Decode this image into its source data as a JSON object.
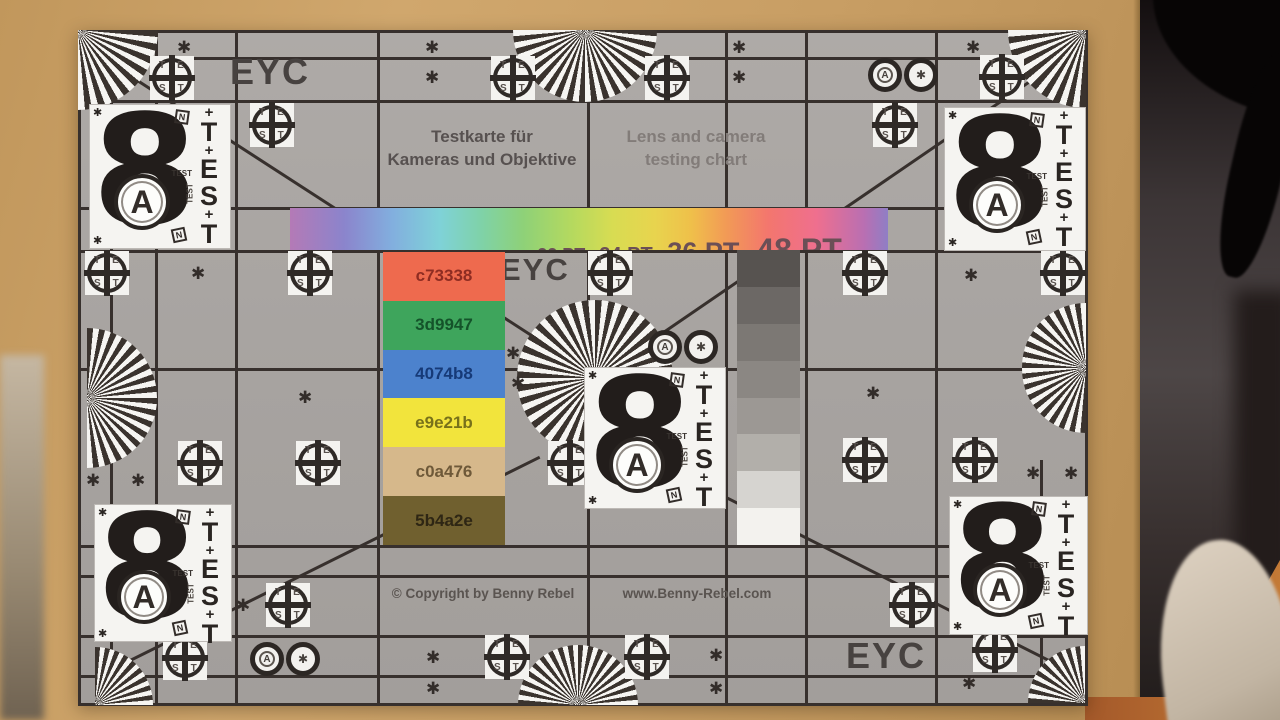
{
  "scene": {
    "cardboard_css": "background:linear-gradient(105deg,#c1975c,#d0a76d 30%,#c89e64 62%,#b88e54)",
    "wall_css": "background:linear-gradient(180deg,#140f10,#3c3536 28%,#4d4646 52%,#372f2e 76%,#201b1a)",
    "bag_css": "background:linear-gradient(160deg,#ded2c2,#c2b5a3 70%,#a89a86)",
    "wood_css": "background:linear-gradient(90deg,#a4592a,#c47a36)",
    "couch_css": "background:linear-gradient(180deg,#c5b7a2,#978871 60%,#6f6251)"
  },
  "chart": {
    "eyc": "EYC",
    "title_de": "Testkarte für\nKameras und Objektive",
    "title_en": "Lens and camera\ntesting chart",
    "copyright": "© Copyright by Benny Rebel",
    "website": "www.Benny-Rebel.com",
    "asterisk": "✱",
    "crosshair": {
      "top": "TE",
      "bottom": "ST"
    },
    "target8": {
      "digit": "8",
      "a": "A",
      "plus": "+",
      "n": "N",
      "small_test": "TEST",
      "test": [
        "T",
        "E",
        "S",
        "T"
      ]
    },
    "font_bar": {
      "gradient_css": "background:linear-gradient(90deg,#b47ab6 0%,#8b84cc 9%,#82aede 17%,#7fd2d8 25%,#7fd2a8 32%,#8ed178 39%,#b4d95f 47%,#d8dc52 54%,#e8d44e 61%,#efc04a 67%,#f29a56 73%,#f3766e 80%,#ef6f8e 88%,#b96fb2 96%,#8f7ec5 100%)",
      "labels": [
        {
          "text": "8 PT",
          "style": "font-size:7px"
        },
        {
          "text": "-",
          "style": "font-size:8px"
        },
        {
          "text": "10 PT",
          "style": "font-size:8px"
        },
        {
          "text": "-",
          "style": "font-size:9px"
        },
        {
          "text": "12 PT",
          "style": "font-size:10px"
        },
        {
          "text": "-",
          "style": "font-size:10px"
        },
        {
          "text": "14 PT",
          "style": "font-size:11px"
        },
        {
          "text": "-",
          "style": "font-size:12px"
        },
        {
          "text": "16 PT",
          "style": "font-size:13px"
        },
        {
          "text": "-",
          "style": "font-size:13px"
        },
        {
          "text": "18 PT",
          "style": "font-size:15px"
        },
        {
          "text": "-",
          "style": "font-size:15px"
        },
        {
          "text": "22 PT",
          "style": "font-size:18px"
        },
        {
          "text": "-",
          "style": "font-size:18px"
        },
        {
          "text": "24 PT",
          "style": "font-size:20px"
        },
        {
          "text": "-",
          "style": "font-size:20px"
        },
        {
          "text": "36 PT",
          "style": "font-size:27px"
        },
        {
          "text": "-",
          "style": "font-size:27px"
        },
        {
          "text": "48 PT",
          "style": "font-size:32px"
        }
      ]
    },
    "swatches": [
      {
        "hex": "c73338",
        "style": "background:#ee6a4e;color:#8e2c22"
      },
      {
        "hex": "3d9947",
        "style": "background:#3ea55c;color:#14532a"
      },
      {
        "hex": "4074b8",
        "style": "background:#4c82cd;color:#163a78"
      },
      {
        "hex": "e9e21b",
        "style": "background:#f2e43c;color:#77711a"
      },
      {
        "hex": "c0a476",
        "style": "background:#d6b88b;color:#6e5939"
      },
      {
        "hex": "5b4a2e",
        "style": "background:#70602f;color:#2e2614"
      }
    ],
    "grayscale": [
      {
        "style": "background:#575350"
      },
      {
        "style": "background:#6c6865"
      },
      {
        "style": "background:#7c7874"
      },
      {
        "style": "background:#8b8783"
      },
      {
        "style": "background:#9c9894"
      },
      {
        "style": "background:#b2afaa"
      },
      {
        "style": "background:#d6d4d0"
      },
      {
        "style": "background:#f3f2ee"
      }
    ],
    "colors": {
      "board": "#a8a4a1",
      "line": "#37302d",
      "white": "#f4f3f0",
      "ink": "#28231f"
    }
  }
}
